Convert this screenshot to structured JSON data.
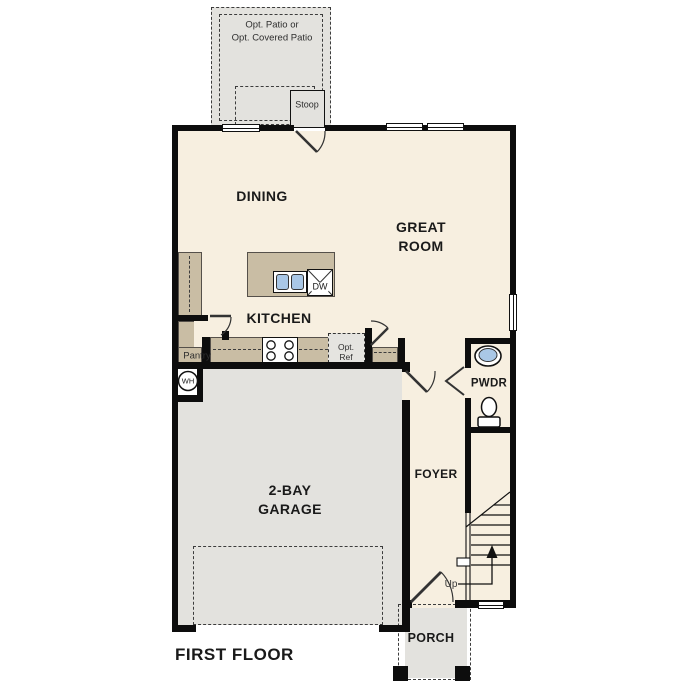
{
  "title": "FIRST FLOOR",
  "colors": {
    "floor": "#f7efe0",
    "cabinet": "#c9bda4",
    "concrete": "#e3e2de",
    "optref": "#e5e4e0",
    "wall": "#0d0d0d",
    "fixture_blue": "#a9c7e6",
    "ink": "#1a1a1a"
  },
  "rooms": {
    "patio": {
      "line1": "Opt. Patio or",
      "line2": "Opt. Covered Patio"
    },
    "stoop": {
      "label": "Stoop"
    },
    "dining": {
      "label": "DINING"
    },
    "great_room": {
      "line1": "GREAT",
      "line2": "ROOM"
    },
    "kitchen": {
      "label": "KITCHEN"
    },
    "island": {
      "dw_label": "DW"
    },
    "pantry": {
      "label": "Pantry"
    },
    "opt_ref": {
      "line1": "Opt.",
      "line2": "Ref"
    },
    "water_heater": {
      "label": "WH"
    },
    "garage": {
      "line1": "2-BAY",
      "line2": "GARAGE"
    },
    "powder": {
      "label": "PWDR"
    },
    "foyer": {
      "label": "FOYER"
    },
    "stairs": {
      "up_label": "Up"
    },
    "porch": {
      "label": "PORCH"
    }
  }
}
